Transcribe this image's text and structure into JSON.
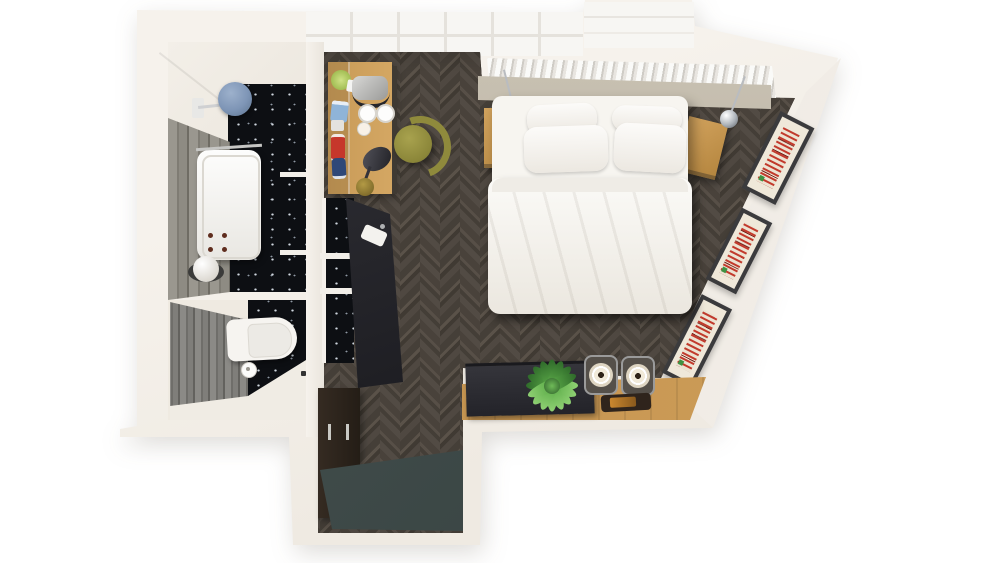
{
  "scene": {
    "kind": "top-down 3d render of a studio apartment floor plan",
    "canvas": {
      "width": 1000,
      "height": 563
    },
    "flooring": {
      "main": "dark herringbone parquet",
      "entry": "teal-grey stone",
      "bathroom": "black terrazzo with white speckles"
    }
  },
  "palette": {
    "background": "#ffffff",
    "wall": "#f4f0ea",
    "floor_dark": "#4a443d",
    "entry_mat": "#3f4b49",
    "starry_tile": "#0d0f13",
    "oak_wood": "#c79a57",
    "olive_chair": "#8f8a3c",
    "bed_linen": "#f6f4ef",
    "headboard_greige": "#b8b0a1",
    "shower_blue": "#7e95b6",
    "counter_dark": "#26262b",
    "art_red": "#c23a2c",
    "plant_green": "#5fae4b"
  },
  "rooms": {
    "bathroom": {
      "label": "Bathroom",
      "items": [
        {
          "name": "rain-shower",
          "label": "Blue rain shower head"
        },
        {
          "name": "bathtub",
          "label": "White bathtub with bronze taps"
        },
        {
          "name": "sphere-lamp",
          "label": "White sphere floor lamp"
        },
        {
          "name": "terrazzo-wall",
          "label": "Black speckled terrazzo panels"
        },
        {
          "name": "grey-tile-wall",
          "label": "Grey tiled wall"
        }
      ]
    },
    "wc": {
      "label": "WC",
      "items": [
        {
          "name": "toilet",
          "label": "White wall-hung toilet"
        },
        {
          "name": "toilet-paper",
          "label": "Toilet paper roll"
        },
        {
          "name": "grey-plank-wall",
          "label": "Grey plank tiled wall"
        }
      ]
    },
    "bedroom": {
      "label": "Studio bedroom",
      "items": [
        {
          "name": "double-bed",
          "label": "Double bed with white duvet and four pillows"
        },
        {
          "name": "headboard",
          "label": "Greige upholstered headboard"
        },
        {
          "name": "radiator",
          "label": "White slatted window radiator"
        },
        {
          "name": "nightstand-left",
          "label": "Oak nightstand left"
        },
        {
          "name": "nightstand-right",
          "label": "Oak nightstand right"
        },
        {
          "name": "pendant-left",
          "label": "Chrome pendant lamp on chain, left"
        },
        {
          "name": "pendant-right",
          "label": "Chrome pendant lamp on chain, right"
        },
        {
          "name": "desk",
          "label": "Oak desk with kettle, cups, toy cars and lamp"
        },
        {
          "name": "desk-chair",
          "label": "Olive green chair"
        },
        {
          "name": "desk-lamp",
          "label": "Black cone desk lamp with brass base"
        },
        {
          "name": "gallery-frames",
          "label": "Three framed red prints on angled wall",
          "count": 3
        },
        {
          "name": "sideboard",
          "label": "Oak sideboard"
        },
        {
          "name": "tv-panel",
          "label": "Dark TV panel on sideboard"
        },
        {
          "name": "plant",
          "label": "Green potted plant"
        },
        {
          "name": "speakers",
          "label": "Pair of round-cone speakers",
          "count": 2
        },
        {
          "name": "phone-tray",
          "label": "Dark tray with phone"
        }
      ]
    },
    "kitchenette": {
      "label": "Kitchenette / entry",
      "items": [
        {
          "name": "counter",
          "label": "Dark counter with small sink"
        },
        {
          "name": "tall-cabinet",
          "label": "Dark tall cabinet with steel handles"
        },
        {
          "name": "entry-mat",
          "label": "Teal-grey entry floor"
        },
        {
          "name": "splashback",
          "label": "Black speckled splashback panels"
        }
      ]
    }
  }
}
